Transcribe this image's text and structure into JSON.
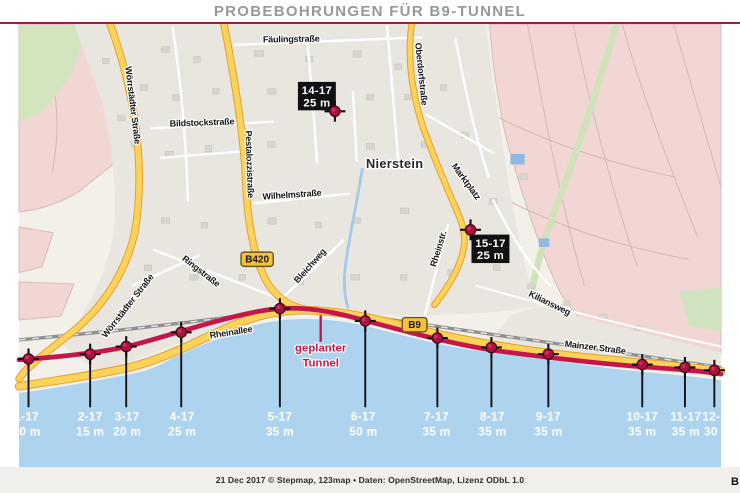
{
  "title": "PROBEBOHRUNGEN FÜR B9-TUNNEL",
  "town": "Nierstein",
  "tunnel_label": [
    "geplanter",
    "Tunnel"
  ],
  "badges": [
    {
      "name": "B420",
      "x": 251,
      "y": 272,
      "w": 34
    },
    {
      "name": "B9",
      "x": 417,
      "y": 341,
      "w": 26
    }
  ],
  "streets": [
    {
      "name": "Fäulingstraße",
      "x": 287,
      "y": 43,
      "rot": -1
    },
    {
      "name": "Wörrstädter Straße",
      "x": 117,
      "y": 110,
      "rot": 83
    },
    {
      "name": "Bildstockstraße",
      "x": 193,
      "y": 131,
      "rot": -2
    },
    {
      "name": "Pestalozzistraße",
      "x": 240,
      "y": 172,
      "rot": 88
    },
    {
      "name": "Oberdorfstraße",
      "x": 421,
      "y": 77,
      "rot": 84
    },
    {
      "name": "Wilhelmstraße",
      "x": 288,
      "y": 207,
      "rot": -4
    },
    {
      "name": "Ringstraße",
      "x": 190,
      "y": 287,
      "rot": 38
    },
    {
      "name": "Bleichweg",
      "x": 309,
      "y": 281,
      "rot": -48
    },
    {
      "name": "Marktplatz",
      "x": 469,
      "y": 192,
      "rot": 54
    },
    {
      "name": "Rheinstr.",
      "x": 445,
      "y": 262,
      "rot": -73
    },
    {
      "name": "Kiliansweg",
      "x": 558,
      "y": 321,
      "rot": 26
    },
    {
      "name": "Wörrstädter Straße",
      "x": 117,
      "y": 323,
      "rot": -52
    },
    {
      "name": "Rheinallee",
      "x": 224,
      "y": 352,
      "rot": -9
    },
    {
      "name": "Mainzer Straße",
      "x": 607,
      "y": 368,
      "rot": 7
    }
  ],
  "boreholes": [
    {
      "id": "1-17",
      "depth": "10 m",
      "mx": 10,
      "my": 377,
      "lx": 8
    },
    {
      "id": "2-17",
      "depth": "15 m",
      "mx": 75,
      "my": 372,
      "lx": 75
    },
    {
      "id": "3-17",
      "depth": "20 m",
      "mx": 113,
      "my": 364,
      "lx": 114
    },
    {
      "id": "4-17",
      "depth": "25 m",
      "mx": 171,
      "my": 349,
      "lx": 172
    },
    {
      "id": "5-17",
      "depth": "35 m",
      "mx": 275,
      "my": 324,
      "lx": 275
    },
    {
      "id": "6-17",
      "depth": "50 m",
      "mx": 365,
      "my": 337,
      "lx": 363
    },
    {
      "id": "7-17",
      "depth": "35 m",
      "mx": 441,
      "my": 355,
      "lx": 440
    },
    {
      "id": "8-17",
      "depth": "35 m",
      "mx": 498,
      "my": 365,
      "lx": 499
    },
    {
      "id": "9-17",
      "depth": "35 m",
      "mx": 558,
      "my": 372,
      "lx": 558
    },
    {
      "id": "10-17",
      "depth": "35 m",
      "mx": 657,
      "my": 383,
      "lx": 657
    },
    {
      "id": "11-17",
      "depth": "35 m",
      "mx": 702,
      "my": 386,
      "lx": 703
    },
    {
      "id": "12-17",
      "depth": "30 m",
      "mx": 733,
      "my": 389,
      "lx": 737
    }
  ],
  "boxed_boreholes": [
    {
      "id": "14-17",
      "depth": "25 m",
      "mx": 333,
      "my": 116,
      "bx": 294,
      "by": 85
    },
    {
      "id": "15-17",
      "depth": "25 m",
      "mx": 476,
      "my": 241,
      "bx": 477,
      "by": 246
    }
  ],
  "footer": {
    "credit": "21 Dec 2017 © Stepmap, 123map • Daten: OpenStreetMap, Lizenz ODbL 1.0",
    "right_fragment": "B"
  },
  "colors": {
    "tunnel": "#c4164b",
    "water": "#aed3ee",
    "road_yellow": "#fbd35b",
    "road_casing": "#e09f2b",
    "marker": "#a8123d",
    "title_rule": "#9d1f3d",
    "vineyard_pink": "#f2d6d4",
    "map_bg": "#f2f0e9"
  }
}
